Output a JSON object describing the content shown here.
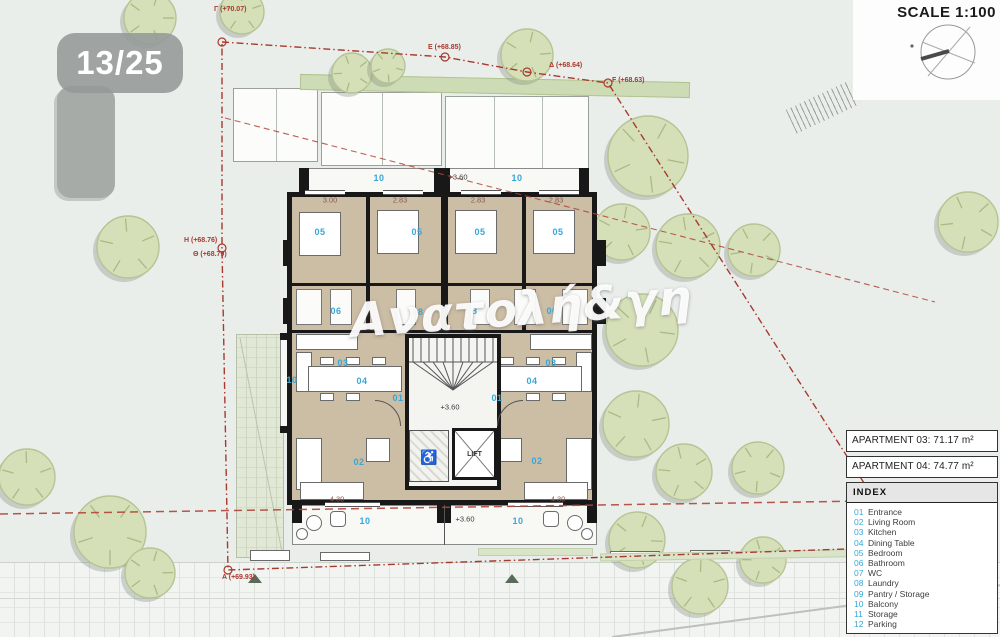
{
  "badge": {
    "label": "13/25"
  },
  "titlebar": {
    "scale_label": "SCALE 1:100"
  },
  "watermark": {
    "text": "Ανατολή&γη"
  },
  "legend": {
    "apartments": [
      "APARTMENT 03: 71.17 m²",
      "APARTMENT 04: 74.77 m²"
    ],
    "index": {
      "title": "INDEX",
      "items": [
        {
          "num": "01",
          "label": "Entrance"
        },
        {
          "num": "02",
          "label": "Living Room"
        },
        {
          "num": "03",
          "label": "Kitchen"
        },
        {
          "num": "04",
          "label": "Dining Table"
        },
        {
          "num": "05",
          "label": "Bedroom"
        },
        {
          "num": "06",
          "label": "Bathroom"
        },
        {
          "num": "07",
          "label": "WC"
        },
        {
          "num": "08",
          "label": "Laundry"
        },
        {
          "num": "09",
          "label": "Pantry / Storage"
        },
        {
          "num": "10",
          "label": "Balcony"
        },
        {
          "num": "11",
          "label": "Storage"
        },
        {
          "num": "12",
          "label": "Parking"
        }
      ]
    }
  },
  "plan": {
    "lift_label": "LIFT",
    "room_labels": [
      {
        "x": 320,
        "y": 232,
        "t": "05"
      },
      {
        "x": 417,
        "y": 232,
        "t": "05"
      },
      {
        "x": 480,
        "y": 232,
        "t": "05"
      },
      {
        "x": 558,
        "y": 232,
        "t": "05"
      },
      {
        "x": 336,
        "y": 311,
        "t": "06"
      },
      {
        "x": 418,
        "y": 312,
        "t": "08"
      },
      {
        "x": 472,
        "y": 311,
        "t": "08"
      },
      {
        "x": 552,
        "y": 311,
        "t": "06"
      },
      {
        "x": 343,
        "y": 363,
        "t": "03"
      },
      {
        "x": 551,
        "y": 363,
        "t": "03"
      },
      {
        "x": 362,
        "y": 381,
        "t": "04"
      },
      {
        "x": 532,
        "y": 381,
        "t": "04"
      },
      {
        "x": 398,
        "y": 398,
        "t": "01"
      },
      {
        "x": 497,
        "y": 398,
        "t": "01"
      },
      {
        "x": 359,
        "y": 462,
        "t": "02"
      },
      {
        "x": 537,
        "y": 461,
        "t": "02"
      },
      {
        "x": 379,
        "y": 178,
        "t": "10"
      },
      {
        "x": 517,
        "y": 178,
        "t": "10"
      },
      {
        "x": 292,
        "y": 380,
        "t": "10"
      },
      {
        "x": 365,
        "y": 521,
        "t": "10"
      },
      {
        "x": 518,
        "y": 521,
        "t": "10"
      }
    ],
    "dim_labels": [
      {
        "x": 330,
        "y": 200,
        "t": "3.00"
      },
      {
        "x": 400,
        "y": 200,
        "t": "2.83"
      },
      {
        "x": 478,
        "y": 200,
        "t": "2.83"
      },
      {
        "x": 556,
        "y": 200,
        "t": "2.83"
      },
      {
        "x": 337,
        "y": 499,
        "t": "4.30"
      },
      {
        "x": 558,
        "y": 499,
        "t": "4.30"
      }
    ],
    "elev_labels": [
      {
        "x": 458,
        "y": 177,
        "t": "+3.60"
      },
      {
        "x": 450,
        "y": 407,
        "t": "+3.60"
      },
      {
        "x": 465,
        "y": 519,
        "t": "+3.60"
      }
    ],
    "boundary_labels": [
      {
        "x": 214,
        "y": 6,
        "t": "Γ (+70.07)"
      },
      {
        "x": 428,
        "y": 44,
        "t": "E (+68.85)"
      },
      {
        "x": 549,
        "y": 62,
        "t": "Δ (+68.64)"
      },
      {
        "x": 612,
        "y": 77,
        "t": "F (+68.63)"
      },
      {
        "x": 184,
        "y": 237,
        "t": "H (+68.76)"
      },
      {
        "x": 193,
        "y": 251,
        "t": "Θ (+68.79)"
      },
      {
        "x": 222,
        "y": 574,
        "t": "A (+69.93)"
      },
      {
        "x": 906,
        "y": 574,
        "t": "B (+69.44)"
      }
    ]
  },
  "site": {
    "trees": [
      {
        "x": 150,
        "y": 18,
        "r": 26
      },
      {
        "x": 242,
        "y": 12,
        "r": 22
      },
      {
        "x": 352,
        "y": 73,
        "r": 20
      },
      {
        "x": 388,
        "y": 66,
        "r": 17
      },
      {
        "x": 527,
        "y": 55,
        "r": 26
      },
      {
        "x": 128,
        "y": 247,
        "r": 31
      },
      {
        "x": 968,
        "y": 222,
        "r": 30
      },
      {
        "x": 648,
        "y": 156,
        "r": 40
      },
      {
        "x": 622,
        "y": 232,
        "r": 28
      },
      {
        "x": 688,
        "y": 246,
        "r": 32
      },
      {
        "x": 754,
        "y": 250,
        "r": 26
      },
      {
        "x": 642,
        "y": 330,
        "r": 36
      },
      {
        "x": 636,
        "y": 424,
        "r": 33
      },
      {
        "x": 684,
        "y": 472,
        "r": 28
      },
      {
        "x": 758,
        "y": 468,
        "r": 26
      },
      {
        "x": 637,
        "y": 540,
        "r": 28
      },
      {
        "x": 700,
        "y": 586,
        "r": 28
      },
      {
        "x": 763,
        "y": 560,
        "r": 23
      },
      {
        "x": 110,
        "y": 532,
        "r": 36
      },
      {
        "x": 150,
        "y": 573,
        "r": 25
      },
      {
        "x": 27,
        "y": 477,
        "r": 28
      }
    ]
  }
}
